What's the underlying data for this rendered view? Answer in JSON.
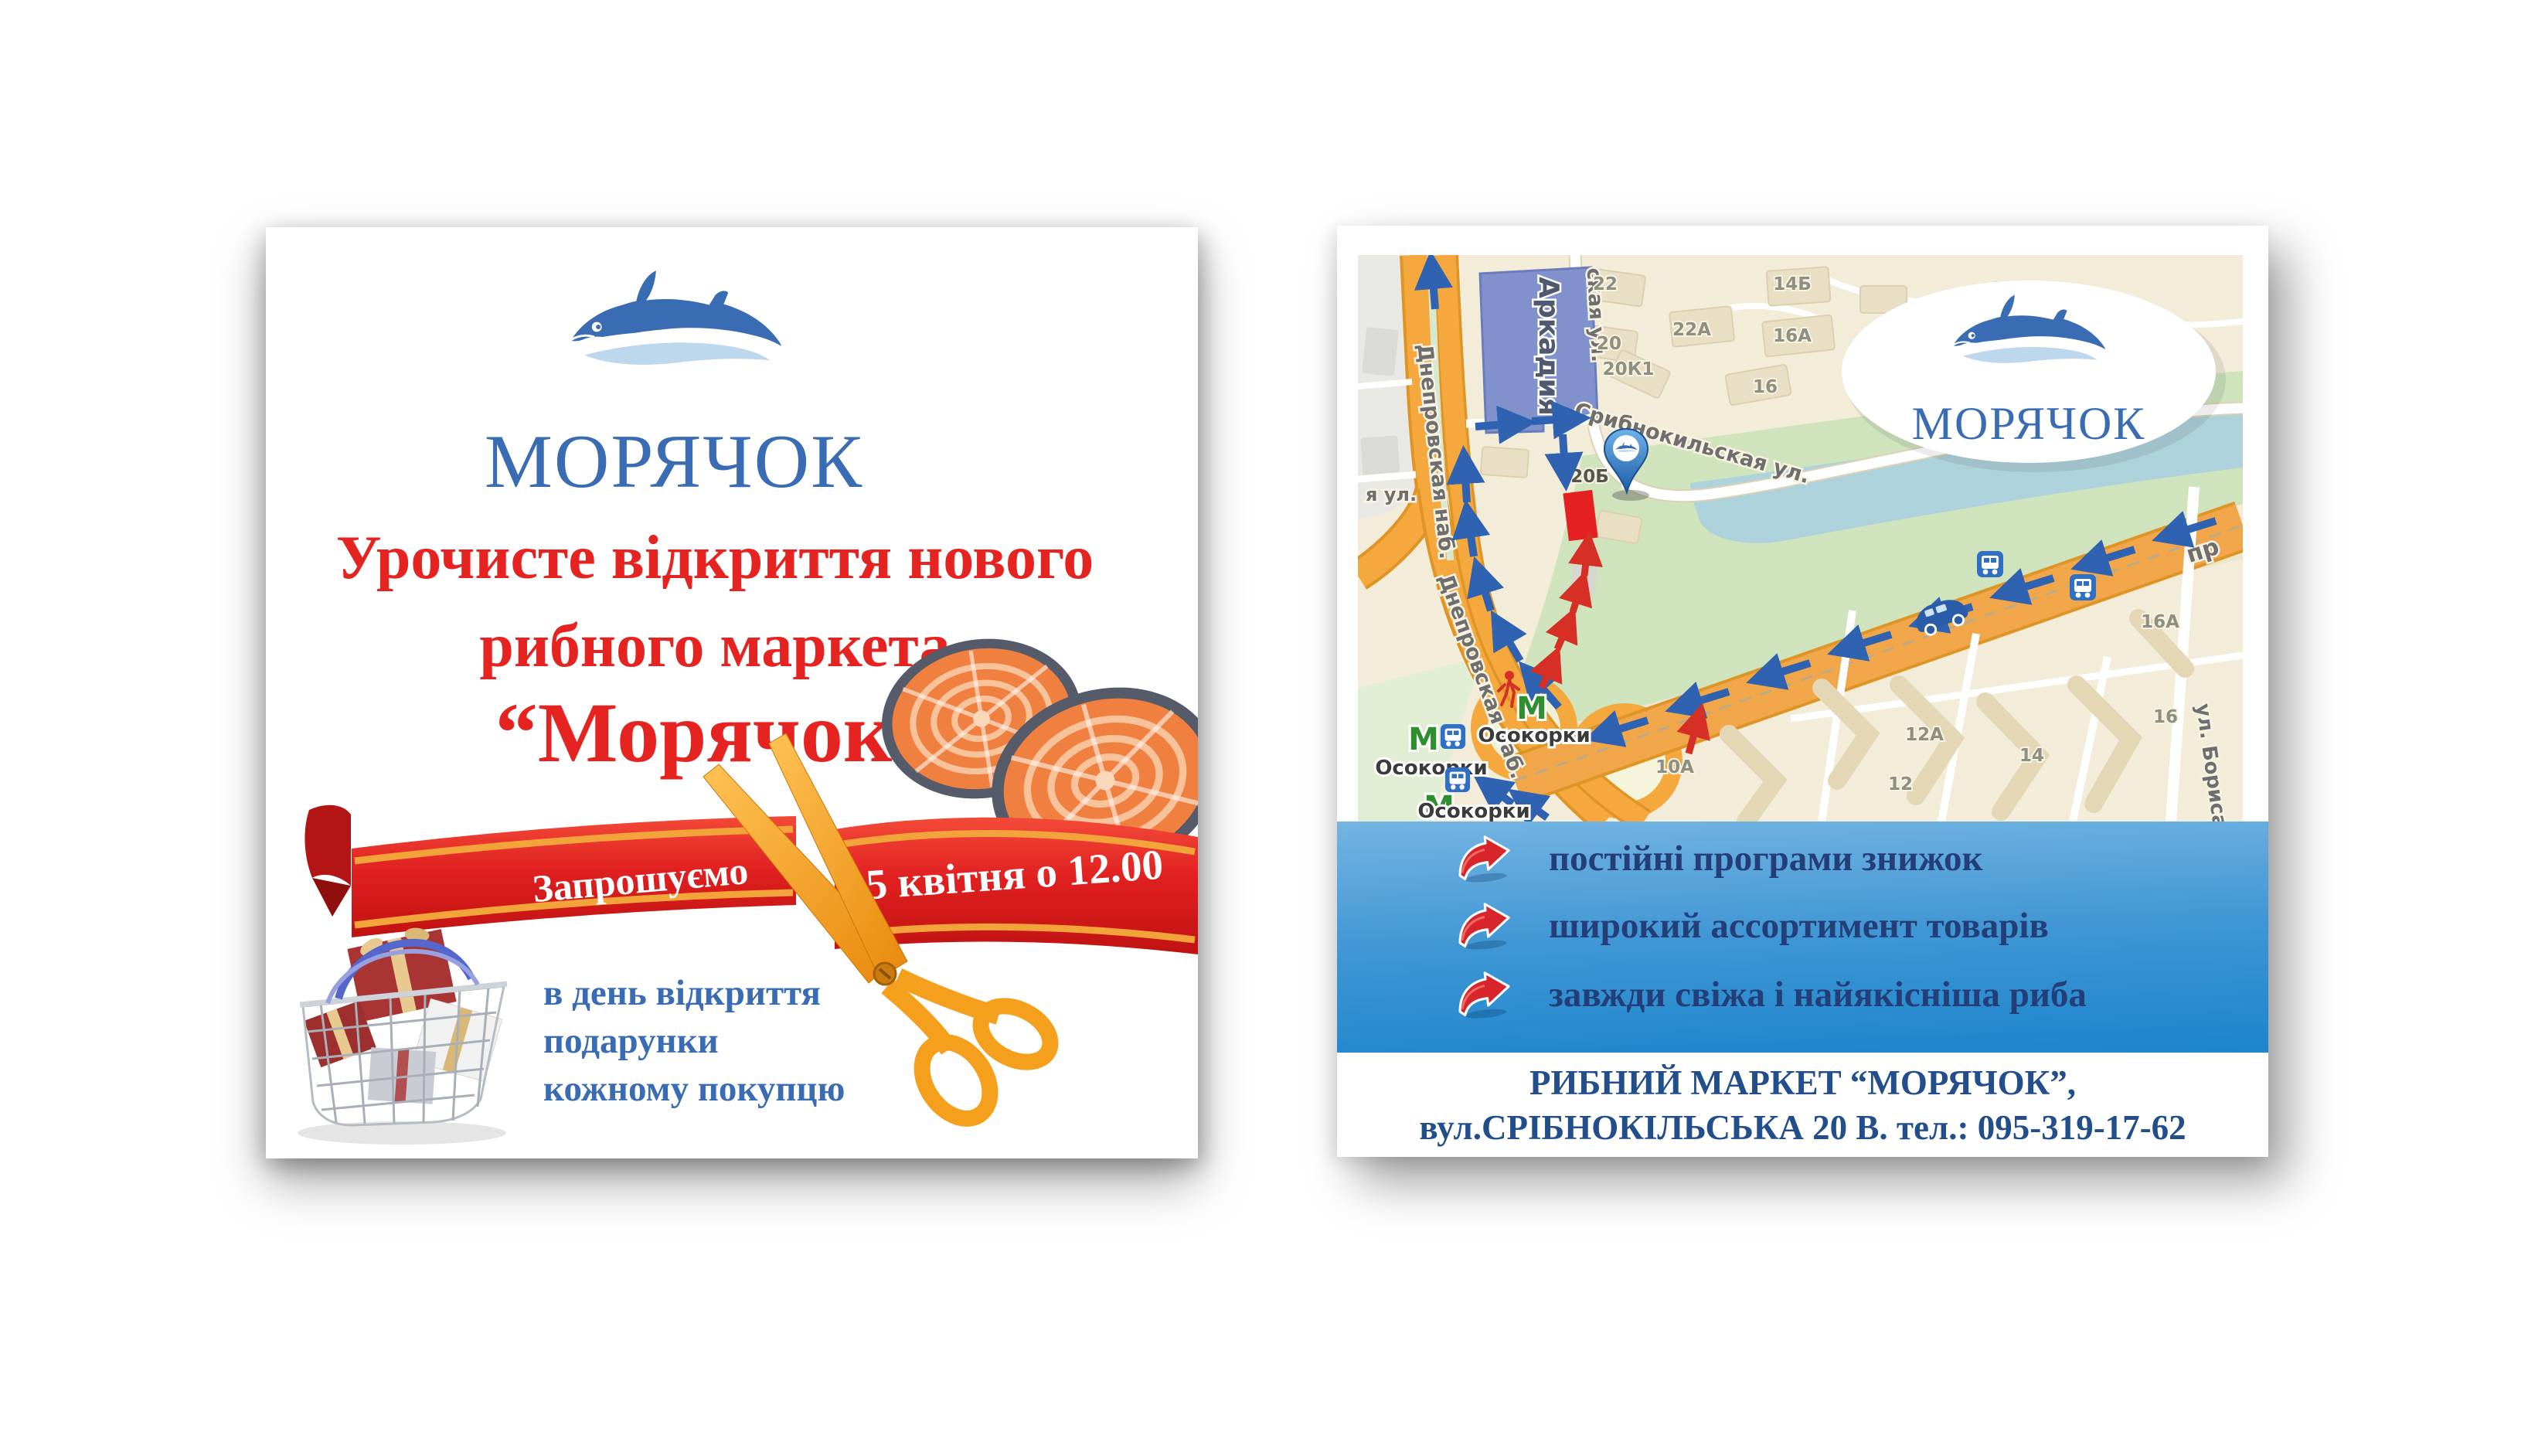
{
  "left_flyer": {
    "brand": "МОРЯЧОК",
    "headline": {
      "line1": "Урочисте відкриття нового",
      "line2": "рибного маркета",
      "line3": "“Морячок”"
    },
    "ribbon": {
      "invite": "Запрошуємо",
      "datetime": "5 квітня о 12.00"
    },
    "gift_note": {
      "line1": "в день відкриття",
      "line2": "подарунки",
      "line3": "кожному покупцю"
    }
  },
  "right_flyer": {
    "brand": "МОРЯЧОК",
    "benefits": [
      "постійні програми знижок",
      "широкий ассортимент товарів",
      "завжди свіжа і найякісніша риба"
    ],
    "contact": {
      "line1": "РИБНИЙ МАРКЕТ “МОРЯЧОК”,",
      "line2": "вул.СРІБНОКІЛЬСЬКА 20 В. тел.: 095-319-17-62"
    },
    "map": {
      "landmark_arkadia": "Аркадия",
      "street_dniprovska": "Днепровская наб.",
      "street_sribnokilska": "Срибнокильская ул.",
      "street_sribnokilska_top": "ская ул.",
      "street_fragment_left": "я ул.",
      "street_borysa": "ул. Бориса",
      "street_prospekt": "пр",
      "metro_symbol": "М",
      "metro_station": "Осокорки",
      "numbers": [
        "22",
        "22А",
        "20",
        "20К1",
        "20Б",
        "14Б",
        "16А",
        "16",
        "10А",
        "12А",
        "14",
        "12",
        "16А",
        "16"
      ]
    }
  },
  "colors": {
    "brand_blue": "#3a6cb3",
    "wave_light_blue": "#bdd7ec",
    "headline_red": "#e52320",
    "ribbon_red": "#d92121",
    "ribbon_gold": "#f2a43b",
    "scissors_orange": "#f5a01d",
    "panel_gradient_top": "#74b4e2",
    "panel_gradient_bottom": "#1b85cc",
    "benefit_navy": "#243e78",
    "contact_navy": "#224e8c",
    "map_highlight_red": "#e42020"
  }
}
